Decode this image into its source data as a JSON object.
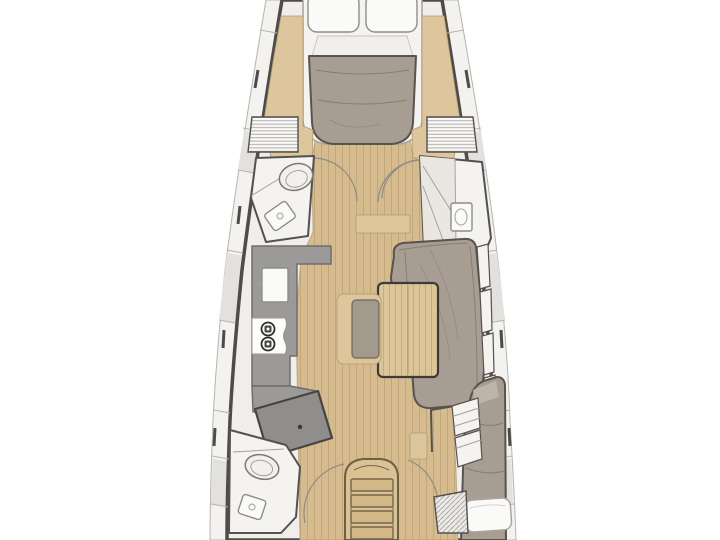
{
  "diagram": {
    "type": "yacht-interior-floor-plan",
    "orientation": "bow-at-top",
    "regions": [
      "forward-cabin-v-berth",
      "forward-head",
      "forward-shower-compartment",
      "corridor",
      "galley",
      "salon-settee",
      "salon-table",
      "nav-station",
      "aft-head",
      "aft-cabin",
      "companionway-stairs"
    ],
    "fixtures": [
      "pillows",
      "mattress",
      "toilet",
      "sink",
      "stove-two-burners",
      "dining-table",
      "bench-seat",
      "hull-lockers",
      "door-swing-arcs",
      "berth-pillow",
      "floor-grate",
      "stairs-four-steps"
    ]
  },
  "colors": {
    "background": "#ffffff",
    "hull_band": "#f3f2ef",
    "hull_band_line": "#b7b4af",
    "hull_band_shade": "#e3e1dd",
    "hull_line": "#4e4c49",
    "interior": "#f0eeea",
    "wood_floor": "#d5bb8e",
    "wood_plank_line": "#c2a77a",
    "wood_trim": "#ddc69c",
    "wood_dark_line": "#8a7a5c",
    "table_wood": "#dcc598",
    "table_grain_line": "#c8ab7c",
    "stairs_wood": "#dac294",
    "upholstery": "#a89d92",
    "upholstery_line": "#877d73",
    "cushion_gray": "#a39a8e",
    "counter_gray": "#9b9a98",
    "desk_gray": "#8f8e8c",
    "room_white": "#f5f3f0",
    "fixture_white": "#fafaf8",
    "fixture_line": "#8f8d89",
    "outline_dark": "#54524e",
    "arc_line": "#8e8b86",
    "hatch_line": "#aeaca7"
  }
}
